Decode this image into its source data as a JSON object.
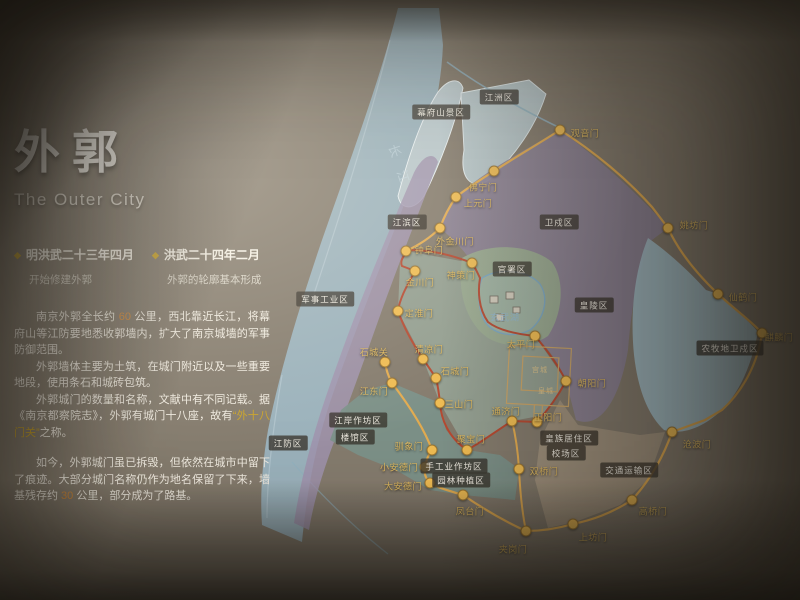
{
  "panel": {
    "title": "外郭",
    "subtitle": "The Outer City",
    "milestones": [
      {
        "date": "明洪武二十三年四月",
        "desc": "开始修建外郭"
      },
      {
        "date": "洪武二十四年二月",
        "desc": "外郭的轮廓基本形成"
      }
    ],
    "paragraphs": {
      "p1_pre": "南京外郭全长约",
      "p1_num": " 60 ",
      "p1_post": "公里，西北靠近长江，将幕府山等江防要地悉收郭墙内，扩大了南京城墙的军事防御范围。",
      "p2": "外郭墙体主要为土筑，在城门附近以及一些重要地段，使用条石和城砖包筑。",
      "p3_pre": "外郭城门的数量和名称，文献中有不同记载。据《南京都察院志》，外郭有城门十八座，故有",
      "p3_hl": "“外十八门关”",
      "p3_post": "之称。",
      "p4_pre": "如今，外郭城门虽已拆毁，但依然在城市中留下了痕迹。大部分城门名称仍作为地名保留了下来，墙基残存约",
      "p4_num": " 30 ",
      "p4_post": "公里，部分成为了路基。"
    }
  },
  "map": {
    "colors": {
      "outer_wall": "#e2ab50",
      "inner_wall": "#b54a32",
      "gate_dot": "#eebb52",
      "river": "#9cb5c2",
      "garrison_purple": "#8b8295",
      "city_green": "#94a092",
      "south_teal": "#7b9189",
      "east_blue": "#a4bfca",
      "transport_tan": "#a2947e"
    },
    "outer_gates": [
      {
        "label": "观音门",
        "x": 560,
        "y": 130,
        "lx": 585,
        "ly": 133
      },
      {
        "label": "佛宁门",
        "x": 494,
        "y": 171,
        "lx": 483,
        "ly": 187
      },
      {
        "label": "上元门",
        "x": 456,
        "y": 197,
        "lx": 478,
        "ly": 203
      },
      {
        "label": "外金川门",
        "x": 440,
        "y": 228,
        "lx": 455,
        "ly": 241
      },
      {
        "label": "姚坊门",
        "x": 668,
        "y": 228,
        "lx": 694,
        "ly": 225
      },
      {
        "label": "仙鹤门",
        "x": 718,
        "y": 294,
        "lx": 743,
        "ly": 297
      },
      {
        "label": "麒麟门",
        "x": 762,
        "y": 333,
        "lx": 779,
        "ly": 337
      },
      {
        "label": "沧波门",
        "x": 672,
        "y": 432,
        "lx": 697,
        "ly": 444
      },
      {
        "label": "高桥门",
        "x": 632,
        "y": 500,
        "lx": 653,
        "ly": 511
      },
      {
        "label": "上坊门",
        "x": 573,
        "y": 524,
        "lx": 593,
        "ly": 537
      },
      {
        "label": "夹岗门",
        "x": 526,
        "y": 531,
        "lx": 513,
        "ly": 549
      },
      {
        "label": "凤台门",
        "x": 463,
        "y": 495,
        "lx": 470,
        "ly": 511
      },
      {
        "label": "大安德门",
        "x": 430,
        "y": 483,
        "lx": 403,
        "ly": 486
      },
      {
        "label": "小安德门",
        "x": 425,
        "y": 467,
        "lx": 399,
        "ly": 467
      },
      {
        "label": "驯象门",
        "x": 432,
        "y": 450,
        "lx": 409,
        "ly": 446
      },
      {
        "label": "江东门",
        "x": 392,
        "y": 383,
        "lx": 374,
        "ly": 391
      },
      {
        "label": "石城关",
        "x": 385,
        "y": 362,
        "lx": 374,
        "ly": 352
      },
      {
        "label": "双桥门",
        "x": 519,
        "y": 469,
        "lx": 544,
        "ly": 471
      }
    ],
    "inner_gates": [
      {
        "label": "神策门",
        "x": 472,
        "y": 263,
        "lx": 461,
        "ly": 275
      },
      {
        "label": "钟阜门",
        "x": 406,
        "y": 251,
        "lx": 429,
        "ly": 250
      },
      {
        "label": "金川门",
        "x": 415,
        "y": 271,
        "lx": 420,
        "ly": 282
      },
      {
        "label": "定淮门",
        "x": 398,
        "y": 311,
        "lx": 419,
        "ly": 313
      },
      {
        "label": "清凉门",
        "x": 423,
        "y": 359,
        "lx": 429,
        "ly": 349
      },
      {
        "label": "石城门",
        "x": 436,
        "y": 378,
        "lx": 455,
        "ly": 371
      },
      {
        "label": "三山门",
        "x": 440,
        "y": 403,
        "lx": 459,
        "ly": 404
      },
      {
        "label": "聚宝门",
        "x": 467,
        "y": 450,
        "lx": 471,
        "ly": 439
      },
      {
        "label": "通济门",
        "x": 512,
        "y": 421,
        "lx": 506,
        "ly": 411
      },
      {
        "label": "正阳门",
        "x": 537,
        "y": 422,
        "lx": 548,
        "ly": 417
      },
      {
        "label": "朝阳门",
        "x": 566,
        "y": 381,
        "lx": 592,
        "ly": 383
      },
      {
        "label": "太平门",
        "x": 535,
        "y": 336,
        "lx": 521,
        "ly": 344
      }
    ],
    "regions": [
      {
        "label": "幕府山景区",
        "x": 441,
        "y": 112
      },
      {
        "label": "江洲区",
        "x": 499,
        "y": 97
      },
      {
        "label": "江滨区",
        "x": 407,
        "y": 222
      },
      {
        "label": "军事工业区",
        "x": 325,
        "y": 299
      },
      {
        "label": "卫戍区",
        "x": 559,
        "y": 222
      },
      {
        "label": "官署区",
        "x": 512,
        "y": 269
      },
      {
        "label": "皇陵区",
        "x": 594,
        "y": 305
      },
      {
        "label": "农牧地卫戍区",
        "x": 730,
        "y": 348
      },
      {
        "label": "江防区",
        "x": 288,
        "y": 443
      },
      {
        "label": "江岸作坊区",
        "x": 358,
        "y": 420
      },
      {
        "label": "楼馆区",
        "x": 355,
        "y": 437
      },
      {
        "label": "手工业作坊区",
        "x": 454,
        "y": 466
      },
      {
        "label": "园林种植区",
        "x": 461,
        "y": 480
      },
      {
        "label": "皇族居住区",
        "x": 569,
        "y": 438
      },
      {
        "label": "校场区",
        "x": 566,
        "y": 453
      },
      {
        "label": "交通运输区",
        "x": 629,
        "y": 470
      }
    ],
    "water_labels": [
      {
        "label": "长江",
        "x": 402,
        "y": 170,
        "kind": "river"
      },
      {
        "label": "玄武湖",
        "x": 505,
        "y": 317,
        "kind": "lake"
      }
    ],
    "palace_labels": [
      {
        "label": "宫城",
        "x": 540,
        "y": 370
      },
      {
        "label": "皇城",
        "x": 546,
        "y": 391
      }
    ]
  }
}
